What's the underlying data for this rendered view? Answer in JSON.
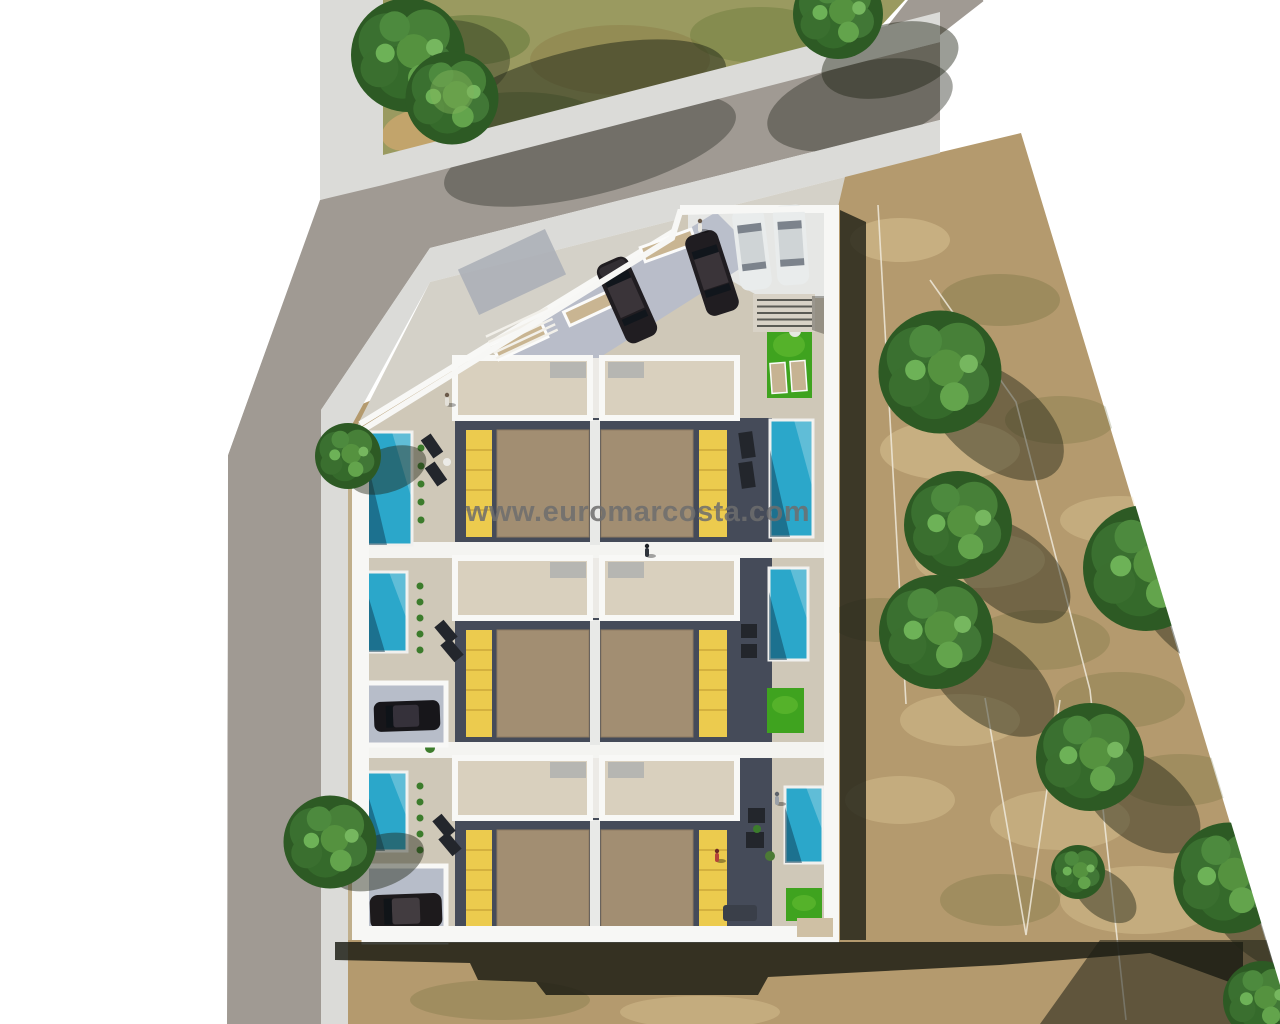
{
  "watermark": {
    "text": "www.euromarcosta.com"
  },
  "palette": {
    "background_white": "#ffffff",
    "field_tan": "#b49a6e",
    "park_grass": "#9a9a60",
    "road_gray": "#a09a93",
    "sidewalk_gray": "#dbdbd8",
    "plaza_beige": "#d4d1c8",
    "plot_base_beige": "#cfc8b8",
    "wall_white": "#f7f7f5",
    "deck_beige": "#d9d0be",
    "terrace_slate": "#454b59",
    "roof_brown": "#a28e72",
    "pergola_yellow": "#eccb4e",
    "pool_teal": "#2ba7ca",
    "lawn_green": "#3fa31f",
    "carport_tile_blue": "#b7bdc9",
    "parking_tile_white": "#e6e7e5",
    "shadow_dark": "rgba(24,26,17,0.82)",
    "watermark_gray": "#6e6e6e"
  },
  "scene": {
    "type": "aerial-3d-site-plan-render",
    "building": {
      "unit_rows": 3,
      "units_per_row": 2,
      "total_units": 6
    },
    "pools": {
      "count": 6
    },
    "lawn_patches": {
      "count": 3
    },
    "vehicles": {
      "plaza_cars_dark": 2,
      "plaza_cars_white": 2,
      "street_cars_white": 1,
      "carport_cars_dark": 2
    },
    "trees": {
      "park": 3,
      "street": 2,
      "field": 8
    },
    "people": {
      "count": 5
    }
  }
}
